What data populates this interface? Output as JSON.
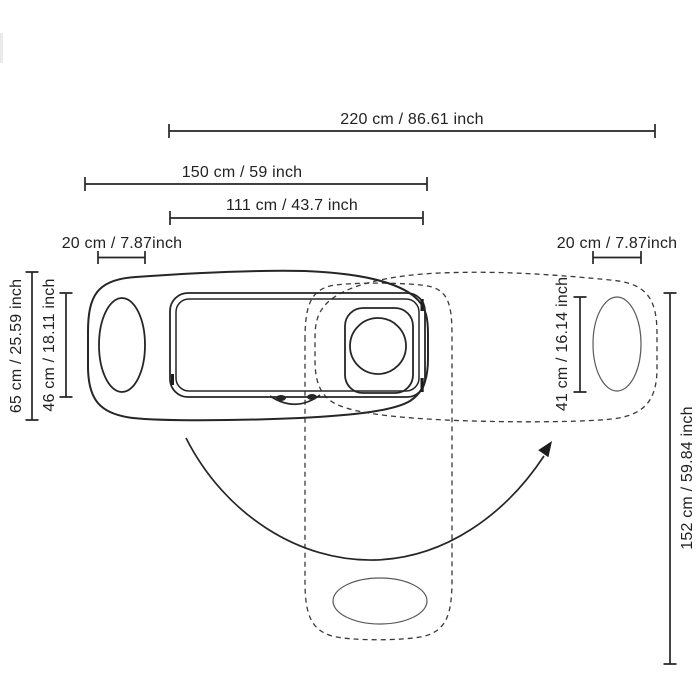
{
  "figure": {
    "line_color": "#262626",
    "dash_color": "#3a3a3a",
    "dims": {
      "total_width": "220 cm / 86.61 inch",
      "table_width": "150 cm / 59 inch",
      "tray_width": "111 cm / 43.7 inch",
      "left_end_width": "20 cm / 7.87inch",
      "right_end_width": "20 cm / 7.87inch",
      "table_depth": "65 cm / 25.59 inch",
      "tray_depth": "46 cm / 18.11 inch",
      "seat_pad_length": "41 cm / 16.14 inch",
      "swing_reach": "152 cm / 59.84 inch"
    }
  }
}
